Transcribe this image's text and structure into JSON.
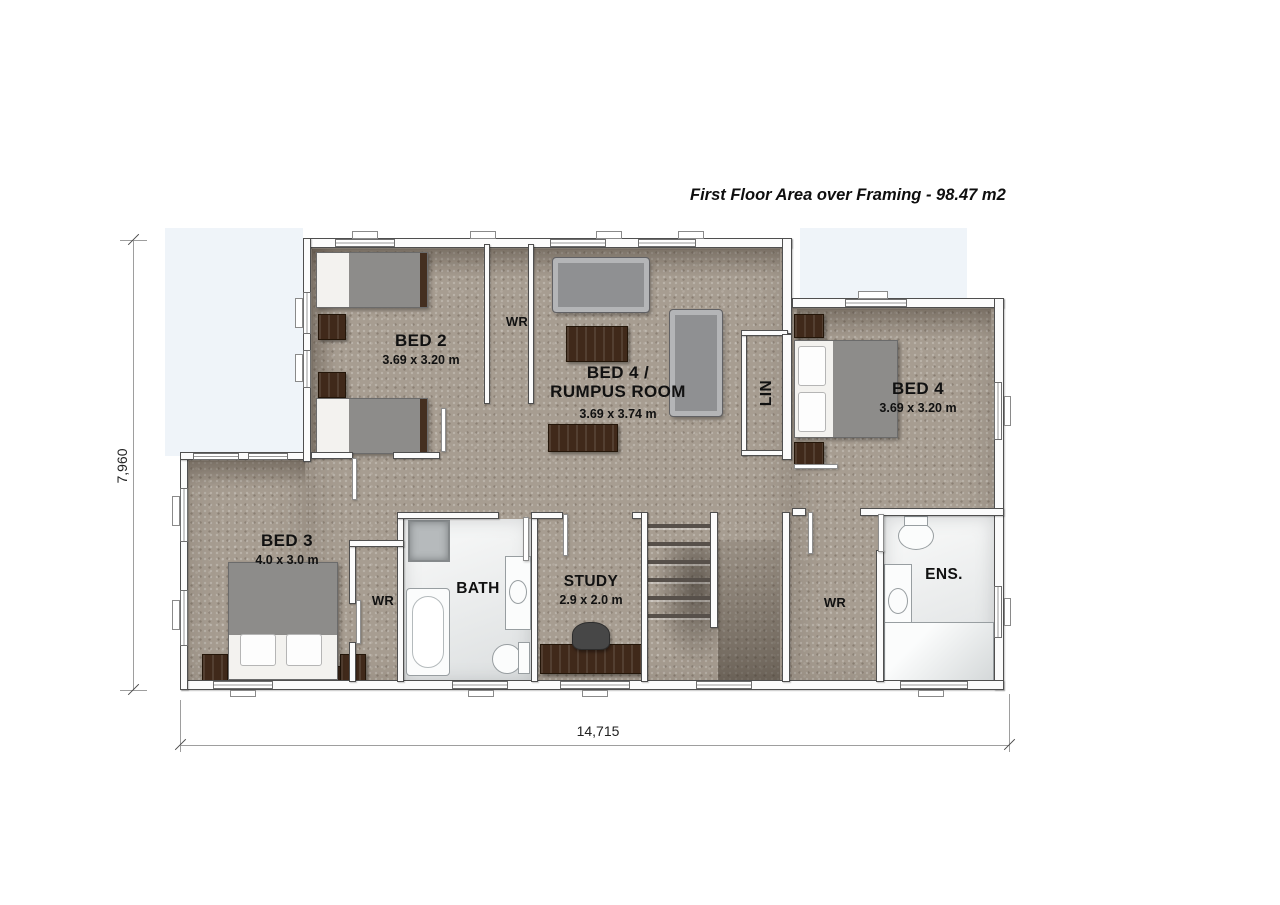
{
  "title": "First Floor Area over Framing - 98.47 m2",
  "dimensions": {
    "overall_width_label": "14,715",
    "overall_height_label": "7,960"
  },
  "rooms": {
    "bed2": {
      "name": "BED 2",
      "size": "3.69 x 3.20 m"
    },
    "bed4_rumpus": {
      "name_line1": "BED 4 /",
      "name_line2": "RUMPUS ROOM",
      "size": "3.69 x 3.74 m"
    },
    "bed4": {
      "name": "BED 4",
      "size": "3.69 x 3.20 m"
    },
    "bed3": {
      "name": "BED 3",
      "size": "4.0 x 3.0 m"
    },
    "study": {
      "name": "STUDY",
      "size": "2.9 x 2.0 m"
    },
    "bath": {
      "name": "BATH"
    },
    "ensuite": {
      "name": "ENS."
    },
    "wardrobe_top": {
      "name": "WR"
    },
    "wardrobe_left": {
      "name": "WR"
    },
    "wardrobe_right": {
      "name": "WR"
    },
    "linen": {
      "name": "LIN"
    }
  },
  "colors": {
    "carpet": "#a79d91",
    "wet_floor": "#e9ecec",
    "wall_fill": "#fbfbfb",
    "wall_outline": "#4f4f4f",
    "roof_void": "#eff4f9",
    "timber_furniture": "#40291a",
    "upholstery": "#8f9092",
    "label_text": "#111111",
    "dimension_line": "#9e9e9e"
  }
}
